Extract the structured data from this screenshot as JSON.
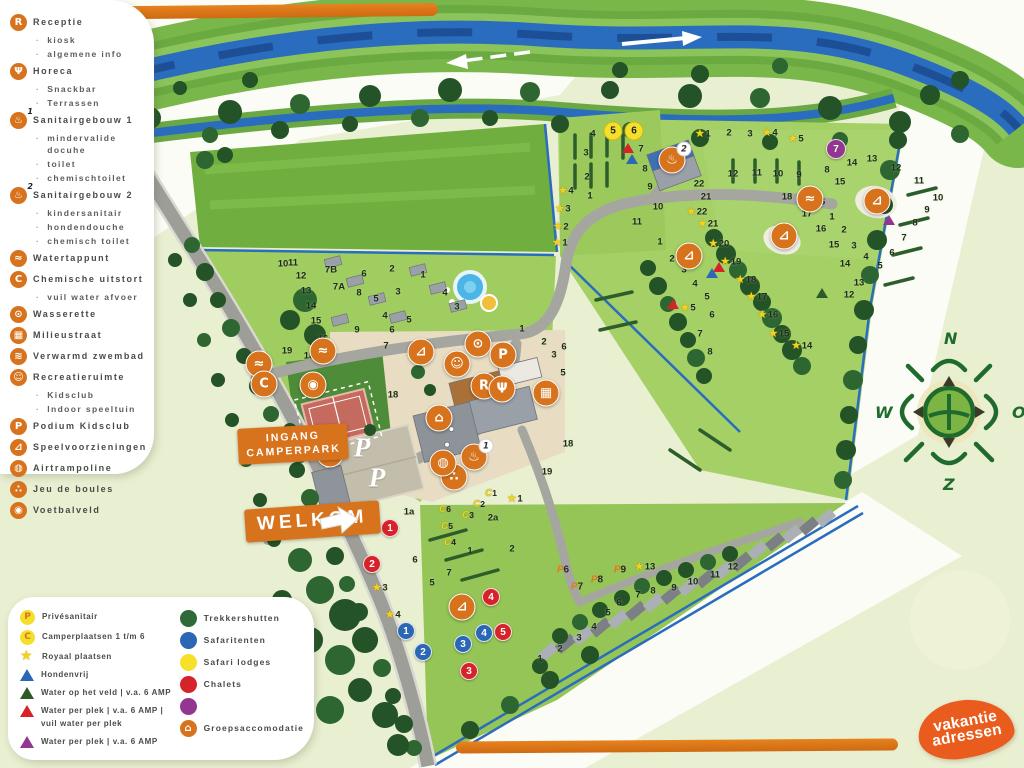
{
  "colors": {
    "accent_orange": "#d8731d",
    "logo_orange": "#e95c1d",
    "dot_green": "#2e6b39",
    "dot_blue": "#2b67b5",
    "dot_yellow": "#f7e02a",
    "dot_red": "#d6232a",
    "dot_purple": "#93368f",
    "tri_darkgreen": "#2e5a28",
    "river_blue": "#2a6cbe",
    "field_green": "#a2cf63"
  },
  "badges": {
    "entrance_line1": "INGANG",
    "entrance_line2": "CAMPERPARK",
    "welcome": "WELKOM"
  },
  "compass": {
    "north": "N",
    "east": "O",
    "south": "Z",
    "west": "W"
  },
  "logo": {
    "line1": "vakantie",
    "line2": "adressen"
  },
  "legend_facilities": {
    "items": [
      {
        "icon": "receptie",
        "label": "Receptie",
        "subs": [
          "kiosk",
          "algemene info"
        ]
      },
      {
        "icon": "horeca",
        "label": "Horeca",
        "gap": false,
        "subs": [
          "Snackbar",
          "Terrassen"
        ]
      },
      {
        "icon": "sanitair",
        "sup": "1",
        "label": "Sanitairgebouw 1",
        "subs": [
          "mindervalide docuhe",
          "toilet",
          "chemischtoilet"
        ]
      },
      {
        "icon": "sanitair",
        "sup": "2",
        "label": "Sanitairgebouw 2",
        "subs": [
          "kindersanitair",
          "hondendouche",
          "chemisch toilet"
        ]
      },
      {
        "icon": "tap",
        "label": "Watertappunt"
      },
      {
        "icon": "chemisch",
        "label": "Chemische uitstort",
        "subs": [
          "vuil water afvoer"
        ]
      },
      {
        "icon": "wasserette",
        "label": "Wasserette"
      },
      {
        "icon": "milieu",
        "label": "Milieustraat"
      },
      {
        "icon": "zwembad",
        "label": "Verwarmd zwembad"
      },
      {
        "icon": "recreatie",
        "label": "Recreatieruimte",
        "subs": [
          "Kidsclub",
          "Indoor speeltuin"
        ]
      },
      {
        "icon": "podium",
        "label": "Podium Kidsclub"
      },
      {
        "icon": "speel",
        "label": "Speelvoorzieningen"
      },
      {
        "icon": "trampoline",
        "label": "Airtrampoline"
      },
      {
        "icon": "boules",
        "label": "Jeu de boules"
      },
      {
        "icon": "voetbal",
        "label": "Voetbalveld"
      }
    ]
  },
  "legend_pitches": {
    "items": [
      {
        "icon": "circle",
        "letter": "P",
        "label": "Privésanitair"
      },
      {
        "icon": "circle",
        "letter": "C",
        "label": "Camperplaatsen 1 t/m 6"
      },
      {
        "icon": "star",
        "label": "Royaal plaatsen"
      },
      {
        "icon": "tri",
        "color": "#2b67b5",
        "label": "Hondenvrij"
      },
      {
        "icon": "tri",
        "color": "#2e5a28",
        "label": "Water op het veld | v.a. 6 AMP"
      },
      {
        "icon": "tri",
        "color": "#d6232a",
        "label": "Water per plek | v.a. 6 AMP |",
        "label2": "vuil water per plek"
      },
      {
        "icon": "tri",
        "color": "#93368f",
        "label": "Water per plek | v.a. 6 AMP"
      }
    ]
  },
  "legend_accommodations": {
    "items": [
      {
        "icon": "dot",
        "color": "#2e6b39",
        "label": "Trekkershutten"
      },
      {
        "icon": "dot",
        "color": "#2b67b5",
        "label": "Safaritenten"
      },
      {
        "icon": "dot",
        "color": "#f7e02a",
        "label": "Safari lodges"
      },
      {
        "icon": "dot",
        "color": "#d6232a",
        "label": "Chalets"
      },
      {
        "icon": "dot",
        "color": "#93368f",
        "label": ""
      },
      {
        "icon": "badge-huis",
        "label": "Groepsaccomodatie"
      }
    ]
  },
  "map": {
    "parking_letter": "P",
    "nums": [
      [
        "4",
        593,
        134
      ],
      [
        "3",
        586,
        153
      ],
      [
        "2",
        587,
        177
      ],
      [
        "1",
        590,
        196
      ],
      [
        "7",
        641,
        149
      ],
      [
        "8",
        645,
        169
      ],
      [
        "9",
        650,
        187
      ],
      [
        "10",
        658,
        207
      ],
      [
        "11",
        637,
        222
      ],
      [
        "1",
        660,
        242
      ],
      [
        "2",
        672,
        259
      ],
      [
        "3",
        684,
        270
      ],
      [
        "4",
        695,
        284
      ],
      [
        "5",
        707,
        297
      ],
      [
        "6",
        712,
        315
      ],
      [
        "7",
        700,
        334
      ],
      [
        "8",
        710,
        352
      ],
      [
        "12",
        733,
        174
      ],
      [
        "11",
        757,
        173
      ],
      [
        "10",
        778,
        174
      ],
      [
        "9",
        799,
        175
      ],
      [
        "8",
        827,
        170
      ],
      [
        "15",
        840,
        182
      ],
      [
        "14",
        852,
        163
      ],
      [
        "13",
        872,
        159
      ],
      [
        "12",
        896,
        168
      ],
      [
        "11",
        919,
        181
      ],
      [
        "10",
        938,
        198
      ],
      [
        "9",
        927,
        210
      ],
      [
        "8",
        915,
        223
      ],
      [
        "7",
        904,
        238
      ],
      [
        "6",
        892,
        253
      ],
      [
        "5",
        880,
        266
      ],
      [
        "13",
        859,
        283
      ],
      [
        "12",
        849,
        295
      ],
      [
        "2",
        729,
        133
      ],
      [
        "3",
        750,
        134
      ],
      [
        "18",
        787,
        197
      ],
      [
        "16",
        820,
        202
      ],
      [
        "17",
        807,
        214
      ],
      [
        "1",
        832,
        217
      ],
      [
        "2",
        844,
        230
      ],
      [
        "3",
        854,
        246
      ],
      [
        "4",
        866,
        257
      ],
      [
        "16",
        821,
        229
      ],
      [
        "15",
        834,
        245
      ],
      [
        "14",
        845,
        264
      ],
      [
        "22",
        699,
        184
      ],
      [
        "21",
        706,
        197
      ],
      [
        "10",
        283,
        264
      ],
      [
        "11",
        293,
        263
      ],
      [
        "12",
        301,
        276
      ],
      [
        "13",
        306,
        291
      ],
      [
        "14",
        311,
        306
      ],
      [
        "15",
        316,
        321
      ],
      [
        "16",
        323,
        339
      ],
      [
        "17",
        328,
        353
      ],
      [
        "18",
        309,
        356
      ],
      [
        "19",
        287,
        351
      ],
      [
        "7B",
        331,
        270
      ],
      [
        "7A",
        339,
        287
      ],
      [
        "6",
        364,
        274
      ],
      [
        "8",
        359,
        293
      ],
      [
        "5",
        376,
        299
      ],
      [
        "9",
        357,
        330
      ],
      [
        "4",
        385,
        316
      ],
      [
        "2",
        392,
        269
      ],
      [
        "3",
        398,
        292
      ],
      [
        "1",
        423,
        275
      ],
      [
        "4",
        445,
        293
      ],
      [
        "3",
        457,
        307
      ],
      [
        "5",
        409,
        320
      ],
      [
        "6",
        392,
        330
      ],
      [
        "7",
        386,
        346
      ],
      [
        "18",
        393,
        395
      ],
      [
        "1a",
        409,
        512
      ],
      [
        "2a",
        493,
        518
      ],
      [
        "6",
        415,
        560
      ],
      [
        "7",
        449,
        573
      ],
      [
        "5",
        432,
        583
      ],
      [
        "1",
        470,
        551
      ],
      [
        "2",
        512,
        549
      ],
      [
        "1",
        522,
        329
      ],
      [
        "2",
        544,
        342
      ],
      [
        "6",
        564,
        347
      ],
      [
        "3",
        554,
        355
      ],
      [
        "5",
        563,
        373
      ],
      [
        "18",
        568,
        444
      ],
      [
        "19",
        547,
        472
      ],
      [
        "1",
        540,
        659
      ],
      [
        "2",
        560,
        649
      ],
      [
        "3",
        579,
        638
      ],
      [
        "4",
        594,
        627
      ],
      [
        "5",
        608,
        613
      ],
      [
        "6",
        619,
        603
      ],
      [
        "7",
        638,
        595
      ],
      [
        "8",
        653,
        591
      ],
      [
        "9",
        674,
        588
      ],
      [
        "10",
        693,
        582
      ],
      [
        "11",
        715,
        575
      ],
      [
        "12",
        733,
        567
      ]
    ],
    "stars": [
      [
        "4",
        566,
        191
      ],
      [
        "3",
        563,
        209
      ],
      [
        "2",
        561,
        227
      ],
      [
        "1",
        560,
        243
      ],
      [
        "1",
        703,
        134
      ],
      [
        "4",
        770,
        133
      ],
      [
        "5",
        796,
        139
      ],
      [
        "22",
        697,
        212
      ],
      [
        "21",
        708,
        224
      ],
      [
        "20",
        719,
        244
      ],
      [
        "19",
        731,
        262
      ],
      [
        "18",
        746,
        280
      ],
      [
        "17",
        757,
        297
      ],
      [
        "16",
        768,
        315
      ],
      [
        "15",
        779,
        334
      ],
      [
        "14",
        802,
        346
      ],
      [
        "3",
        380,
        588
      ],
      [
        "4",
        393,
        615
      ],
      [
        "1",
        515,
        499
      ],
      [
        "5",
        688,
        308
      ],
      [
        "13",
        645,
        567
      ]
    ],
    "campers": [
      [
        "5",
        613,
        131
      ],
      [
        "6",
        634,
        131
      ]
    ],
    "clabels": [
      [
        "C",
        "1",
        491,
        492
      ],
      [
        "C",
        "2",
        479,
        503
      ],
      [
        "C",
        "3",
        468,
        514
      ],
      [
        "C",
        "6",
        445,
        508
      ],
      [
        "C",
        "5",
        447,
        525
      ],
      [
        "C",
        "4",
        450,
        541
      ]
    ],
    "chalets": [
      [
        "1",
        390,
        528
      ],
      [
        "2",
        372,
        564
      ],
      [
        "3",
        469,
        671
      ],
      [
        "4",
        491,
        597
      ],
      [
        "5",
        503,
        632
      ]
    ],
    "tents": [
      [
        "1",
        406,
        631
      ],
      [
        "2",
        423,
        652
      ],
      [
        "3",
        463,
        644
      ],
      [
        "4",
        484,
        633
      ]
    ],
    "purples": [
      [
        "7",
        836,
        149
      ]
    ],
    "plabels": [
      [
        "6",
        563,
        570
      ],
      [
        "7",
        577,
        587
      ],
      [
        "8",
        597,
        580
      ],
      [
        "9",
        620,
        570
      ]
    ],
    "tris": [
      [
        "#d6232a",
        628,
        148
      ],
      [
        "#2b67b5",
        632,
        159
      ],
      [
        "#d6232a",
        719,
        267
      ],
      [
        "#2b67b5",
        712,
        273
      ],
      [
        "#93368f",
        889,
        220
      ],
      [
        "#2e5a28",
        822,
        293
      ],
      [
        "#d6232a",
        673,
        304
      ]
    ],
    "badges": [
      [
        "voetbal",
        313,
        385
      ],
      [
        "tap",
        323,
        351
      ],
      [
        "tap",
        259,
        364
      ],
      [
        "chemisch",
        264,
        384
      ],
      [
        "speel",
        421,
        352
      ],
      [
        "wasserette",
        478,
        344
      ],
      [
        "recreatie",
        457,
        364
      ],
      [
        "podium",
        503,
        355
      ],
      [
        "receptie",
        484,
        386
      ],
      [
        "horeca",
        502,
        389
      ],
      [
        "milieu",
        546,
        393
      ],
      [
        "huis",
        439,
        418
      ],
      [
        "milieu",
        330,
        454
      ],
      [
        "sanitair",
        474,
        457,
        "1"
      ],
      [
        "boules",
        454,
        477
      ],
      [
        "trampoline",
        443,
        463
      ],
      [
        "sanitair",
        672,
        160,
        "2"
      ],
      [
        "tap",
        810,
        199
      ],
      [
        "speel",
        877,
        201
      ],
      [
        "speel",
        784,
        236
      ],
      [
        "speel",
        689,
        256
      ],
      [
        "speel",
        462,
        607
      ]
    ],
    "pbig": [
      [
        362,
        448
      ],
      [
        377,
        478
      ]
    ]
  }
}
